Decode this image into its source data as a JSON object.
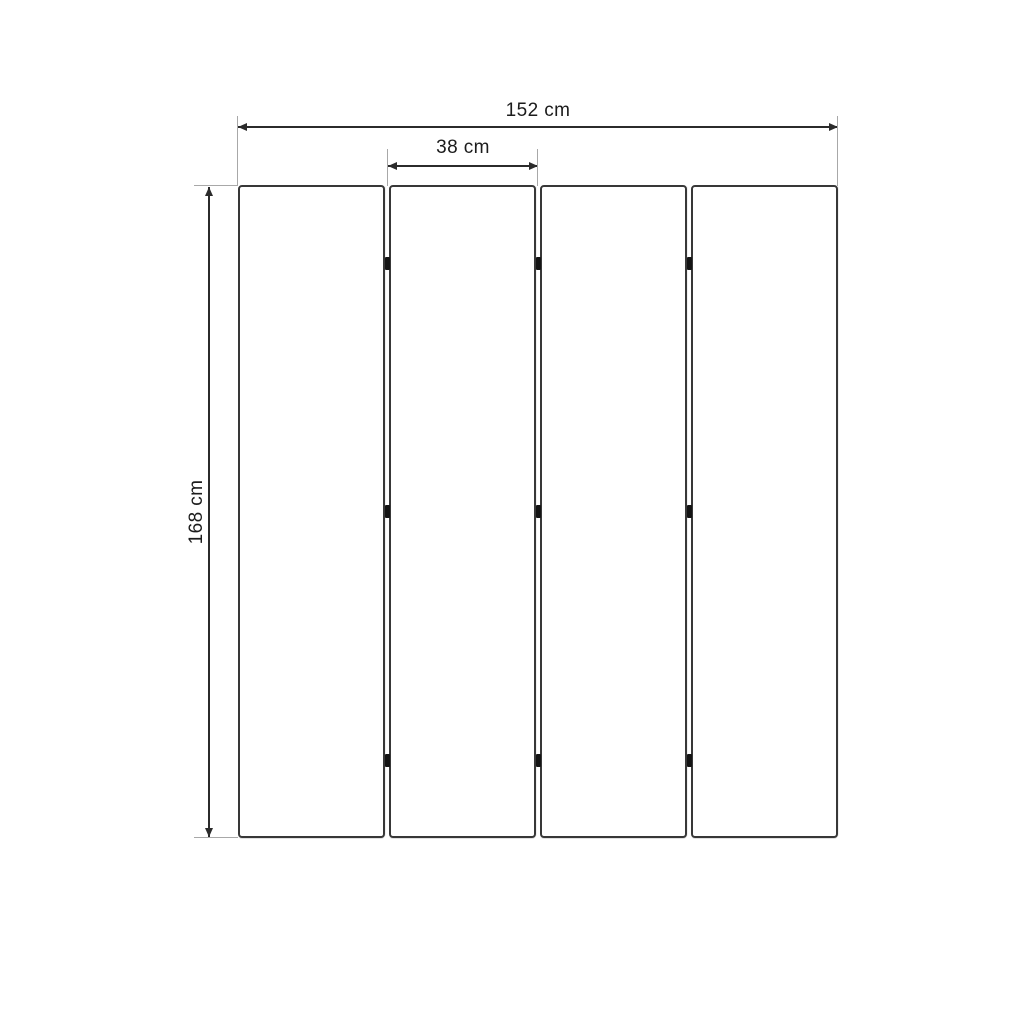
{
  "drawing": {
    "title": "four-panel folding screen dimension drawing",
    "object": "room divider with 4 panels joined by hinges",
    "panel_count": 4,
    "joint_count": 3,
    "hinges_per_joint": 3,
    "dimensions": {
      "total_width": {
        "label": "152 cm",
        "value": 152,
        "unit": "cm"
      },
      "panel_width": {
        "label": "38 cm",
        "value": 38,
        "unit": "cm"
      },
      "height": {
        "label": "168 cm",
        "value": 168,
        "unit": "cm"
      }
    },
    "colors": {
      "background": "#ffffff",
      "dimension_line": "#2b2b2b",
      "extension_line": "#a8a8a8",
      "panel_outline": "#383838",
      "hinge": "#141414",
      "text": "#1c1c1c"
    }
  }
}
